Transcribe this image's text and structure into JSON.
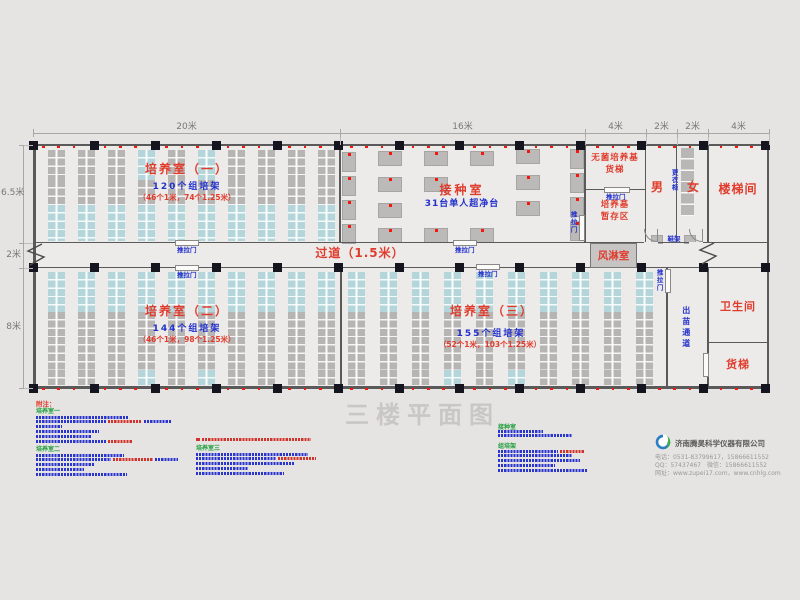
{
  "title": "三楼平面图",
  "dimensions": {
    "top": [
      {
        "label": "20米",
        "from": 33,
        "to": 340
      },
      {
        "label": "16米",
        "from": 340,
        "to": 585
      },
      {
        "label": "4米",
        "from": 585,
        "to": 646
      },
      {
        "label": "2米",
        "from": 646,
        "to": 677
      },
      {
        "label": "2米",
        "from": 677,
        "to": 708
      },
      {
        "label": "4米",
        "from": 708,
        "to": 769
      }
    ],
    "left": [
      {
        "label": "6.5米",
        "from": 145,
        "to": 243
      },
      {
        "label": "2米",
        "from": 243,
        "to": 268
      },
      {
        "label": "8米",
        "from": 268,
        "to": 388
      }
    ]
  },
  "rooms": {
    "room1": {
      "name": "培养室（一）",
      "racks": "120个组培架",
      "detail": "（46个1米，74个1.25米）"
    },
    "room2": {
      "name": "培养室（二）",
      "racks": "144个组培架",
      "detail": "（46个1米，98个1.25米）"
    },
    "room3": {
      "name": "培养室（三）",
      "racks": "155个组培架",
      "detail": "（52个1米，103个1.25米）"
    },
    "inoculation": {
      "name": "接种室",
      "detail": "31台单人超净台"
    },
    "medium_elevator_lines": [
      "无菌培养基",
      "货梯"
    ],
    "medium_storage_lines": [
      "培养基",
      "暂存区"
    ],
    "male": "男",
    "female": "女",
    "stairwell": "楼梯间",
    "corridor": "过道（1.5米）",
    "air_shower": "风淋室",
    "toilet": "卫生间",
    "freight_elevator": "货梯",
    "seedling_passage": "出苗通道",
    "wardrobe": "更衣柜",
    "shoe_rack": "鞋架",
    "sliding_door": "推拉门"
  },
  "notes": {
    "heading": "附注：",
    "columns": [
      {
        "x": 36,
        "blocks": [
          {
            "h": "培养室一",
            "hy": 409,
            "ly": 415.5,
            "lines": [
              [
                [
                  93,
                  "b"
                ]
              ],
              [
                [
                  70,
                  "b"
                ],
                [
                  34,
                  "r"
                ],
                [
                  27,
                  "b"
                ]
              ],
              [
                [
                  26,
                  "b"
                ]
              ],
              [
                [
                  63,
                  "b"
                ]
              ],
              [
                [
                  55,
                  "b"
                ]
              ],
              [
                [
                  70,
                  "b"
                ],
                [
                  25,
                  "r"
                ]
              ]
            ]
          },
          {
            "h": "培养室二",
            "hy": 447,
            "ly": 453.5,
            "lines": [
              [
                [
                  88,
                  "b"
                ]
              ],
              [
                [
                  75,
                  "b"
                ],
                [
                  40,
                  "r"
                ],
                [
                  23,
                  "b"
                ]
              ],
              [
                [
                  58,
                  "b"
                ]
              ],
              [
                [
                  48,
                  "b"
                ]
              ],
              [
                [
                  91,
                  "b"
                ]
              ]
            ]
          }
        ]
      },
      {
        "x": 196,
        "blocks": [
          {
            "h": "",
            "hy": 0,
            "ly": 438,
            "lines": [
              [
                [
                  4,
                  "q"
                ],
                [
                  109,
                  "r"
                ]
              ]
            ]
          },
          {
            "h": "培养室三",
            "hy": 446,
            "ly": 452.5,
            "lines": [
              [
                [
                  112,
                  "b"
                ]
              ],
              [
                [
                  80,
                  "b"
                ],
                [
                  38,
                  "r"
                ]
              ],
              [
                [
                  98,
                  "b"
                ]
              ],
              [
                [
                  52,
                  "b"
                ]
              ],
              [
                [
                  88,
                  "b"
                ]
              ]
            ]
          }
        ]
      },
      {
        "x": 498,
        "blocks": [
          {
            "h": "接种室",
            "hy": 425,
            "ly": 429.5,
            "lines": [
              [
                [
                  45,
                  "b"
                ]
              ],
              [
                [
                  74,
                  "b"
                ]
              ]
            ]
          },
          {
            "h": "组培架",
            "hy": 444,
            "ly": 449.5,
            "lines": [
              [
                [
                  60,
                  "b"
                ],
                [
                  25,
                  "r"
                ]
              ],
              [
                [
                  74,
                  "b"
                ]
              ],
              [
                [
                  82,
                  "b"
                ]
              ],
              [
                [
                  57,
                  "b"
                ]
              ],
              [
                [
                  89,
                  "b"
                ]
              ]
            ]
          }
        ]
      }
    ]
  },
  "footer": {
    "company": "济南腾昊科学仪器有限公司",
    "phone": "电话：0531-83799617，15866611552",
    "qq": "QQ：57437467　微信：15866611552",
    "web": "网址：www.zupei17.com，www.cnhlg.com"
  },
  "colors": {
    "red": "#e03c2d",
    "blue": "#2230cc",
    "green": "#1f9e3e",
    "rack_gray": "#b7b5b3",
    "rack_cyan": "#b4d5d9",
    "wall": "#5a5a5a",
    "column": "#15151f",
    "dim_line": "#a9a8a6",
    "floor": "#edebe9",
    "background": "#e6e4e2",
    "title_gray": "#c9c7c5"
  }
}
